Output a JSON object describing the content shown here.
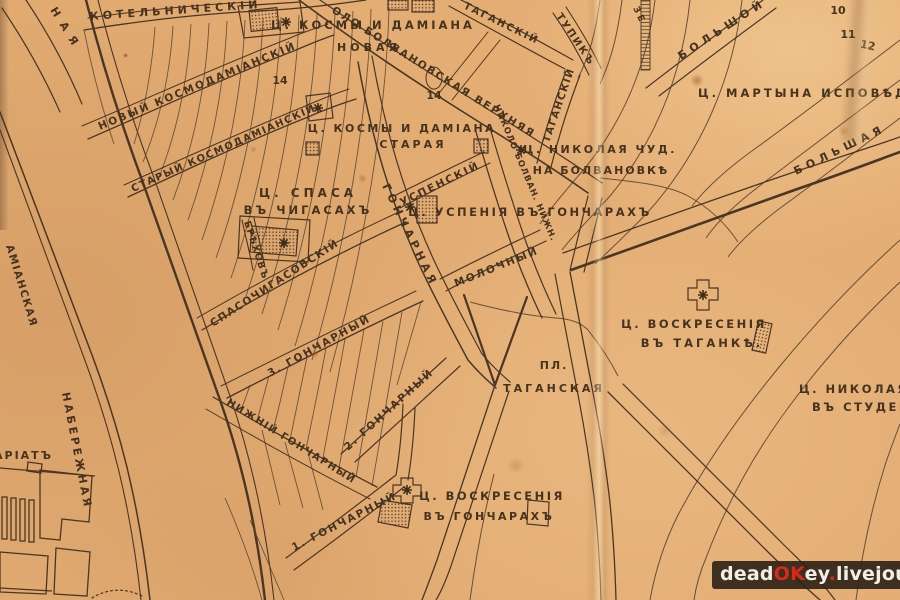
{
  "map": {
    "labels": {
      "kotelnichesky": "КОТЕЛЬНИЧЕСКІЙ",
      "naya_fragment": "НАЯ",
      "kosmy_damiana_new_1": "Ц. КОСМЫ И ДАМІАНА",
      "kosmy_damiana_new_2": "НОВАЯ",
      "kosmy_damiana_old_1": "Ц. КОСМЫ И ДАМІАНА",
      "kosmy_damiana_old_2": "СТАРАЯ",
      "novy_kosmodamiansky": "НОВЫЙ КОСМОДАМІАНСКІЙ",
      "stary_kosmodamiansky": "СТАРЫЙ КОСМОДАМІАНСКІЙ",
      "brehov": "БРѢХОВЪ",
      "spasochigasovsky": "СПАСОЧИГАСОВСКІЙ",
      "spasa_1": "Ц. СПАСА",
      "spasa_2": "ВЪ ЧИГАСАХЪ",
      "goncharnaya": "ГОНЧАРНАЯ",
      "uspensky": "УСПЕНСКІЙ",
      "uspeniya": "Ц. УСПЕНІЯ ВЪ ГОНЧАРАХЪ",
      "molochny": "МОЛОЧНЫЙ",
      "bolvanovskaya_verh": "ОЛО БОЛВАНОВСКАЯ ВЕРХНЯЯ",
      "nikolo_bolvan_nizh": "НИКОЛО БОЛВАН. НИЖН.",
      "nikolaya_chud_1": "Ц. НИКОЛАЯ ЧУД.",
      "nikolaya_chud_2": "НА БОЛВАНОВКѢ",
      "tagansky_diag": "ТАГАНСКІЙ",
      "tupik": "ТУПИКЪ",
      "tagansky_vert": "ТАГАНСКІЙ",
      "ze_fragment": "ЗЕ",
      "bolshoy": "БОЛЬШОЙ",
      "bolshaya": "БОЛЬШАЯ",
      "martyna": "Ц. МАРТЫНА ИСПОВѢДНИ",
      "voskreseniya_tag_1": "Ц. ВОСКРЕСЕНІЯ",
      "voskreseniya_tag_2": "ВЪ ТАГАНКѢ.",
      "pl": "ПЛ.",
      "taganskaya": "ТАГАНСКАЯ",
      "nikolaya_stud_1": "Ц. НИКОЛАЯ Ч",
      "nikolaya_stud_2": "ВЪ СТУДЕНЦ",
      "goncharny3": "3. ГОНЧАРНЫЙ",
      "goncharny2": "2. ГОНЧАРНЫЙ",
      "nizhny_goncharny": "НИЖНІЙ ГОНЧАРНЫЙ",
      "goncharny1": "1. ГОНЧАРНЫЙ",
      "voskreseniya_gon_1": "Ц. ВОСКРЕСЕНІЯ",
      "voskreseniya_gon_2": "ВЪ ГОНЧАРАХЪ",
      "naberezhnaya": "НАБЕРЕЖНАЯ",
      "amianskaya": "АМІАНСКАЯ",
      "kommissariat_fragment": "АРІАТЪ",
      "n14a": "14",
      "n14b": "14",
      "n10": "10",
      "n11": "11",
      "n12": "12"
    },
    "colors": {
      "paper": "#e3ad74",
      "paper_light": "#f3d29e",
      "ink": "#4a3624",
      "ink_thin": "#5f4a33",
      "label_ink": "#46331f"
    }
  },
  "watermark": {
    "segments": [
      {
        "text": "dead",
        "color": "#f3efe6"
      },
      {
        "text": "OK",
        "color": "#d92a17"
      },
      {
        "text": "ey",
        "color": "#f3efe6"
      },
      {
        "text": ".",
        "color": "#d92a17"
      },
      {
        "text": "livejournal",
        "color": "#f3efe6"
      },
      {
        "text": ".",
        "color": "#d92a17"
      },
      {
        "text": "com",
        "color": "#f3efe6"
      }
    ],
    "background": "#2b2117"
  }
}
